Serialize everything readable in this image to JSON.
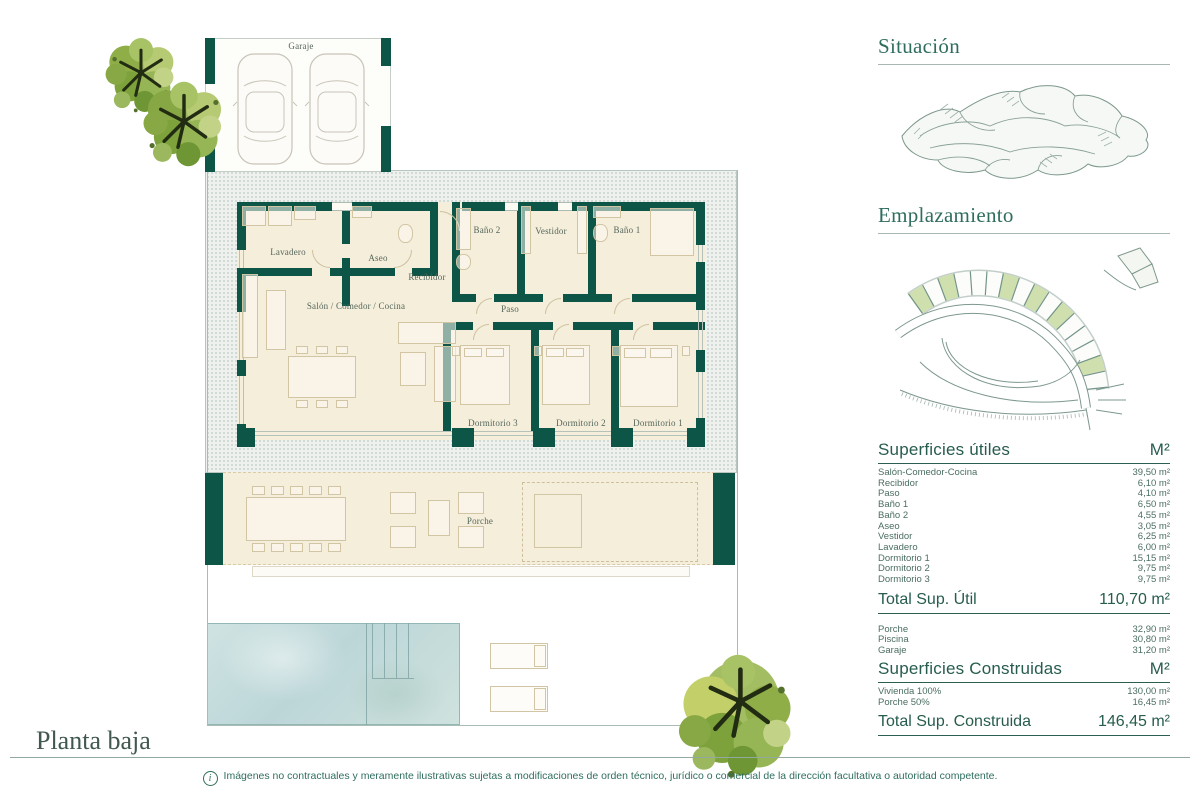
{
  "plan": {
    "title": "Planta baja",
    "rooms": {
      "garaje": "Garaje",
      "lavadero": "Lavadero",
      "aseo": "Aseo",
      "recibidor": "Recibidor",
      "salon": "Salón / Comedor / Cocina",
      "paso": "Paso",
      "bano2": "Baño 2",
      "vestidor": "Vestidor",
      "bano1": "Baño 1",
      "dorm3": "Dormitorio 3",
      "dorm2": "Dormitorio 2",
      "dorm1": "Dormitorio 1",
      "porche": "Porche"
    }
  },
  "sidebar": {
    "situacion_title": "Situación",
    "emplazamiento_title": "Emplazamiento",
    "utiles": {
      "title": "Superficies útiles",
      "unit": "M²",
      "rows": [
        {
          "label": "Salón-Comedor-Cocina",
          "value": "39,50 m²"
        },
        {
          "label": "Recibidor",
          "value": "6,10 m²"
        },
        {
          "label": "Paso",
          "value": "4,10 m²"
        },
        {
          "label": "Baño 1",
          "value": "6,50 m²"
        },
        {
          "label": "Baño 2",
          "value": "4,55 m²"
        },
        {
          "label": "Aseo",
          "value": "3,05 m²"
        },
        {
          "label": "Vestidor",
          "value": "6,25 m²"
        },
        {
          "label": "Lavadero",
          "value": "6,00 m²"
        },
        {
          "label": "Dormitorio 1",
          "value": "15,15 m²"
        },
        {
          "label": "Dormitorio 2",
          "value": "9,75 m²"
        },
        {
          "label": "Dormitorio 3",
          "value": "9,75 m²"
        }
      ],
      "total_label": "Total Sup. Útil",
      "total_value": "110,70 m²"
    },
    "exterior_rows": [
      {
        "label": "Porche",
        "value": "32,90 m²"
      },
      {
        "label": "Piscina",
        "value": "30,80 m²"
      },
      {
        "label": "Garaje",
        "value": "31,20 m²"
      }
    ],
    "construidas": {
      "title": "Superficies Construidas",
      "unit": "M²",
      "rows": [
        {
          "label": "Vivienda 100%",
          "value": "130,00 m²"
        },
        {
          "label": "Porche 50%",
          "value": "16,45 m²"
        }
      ],
      "total_label": "Total Sup. Construida",
      "total_value": "146,45 m²"
    }
  },
  "footer": {
    "info_icon": "i",
    "disclaimer": "Imágenes no contractuales y meramente ilustrativas sujetas a modificaciones de orden técnico, jurídico o comercial de la dirección facultativa o autoridad competente."
  },
  "colors": {
    "wall_green": "#0c5547",
    "heading_green": "#2f6e5f",
    "floor_cream": "#f5eedb",
    "pool_blue": "#c6dcdc",
    "plot_highlight": "#cfdfae"
  }
}
